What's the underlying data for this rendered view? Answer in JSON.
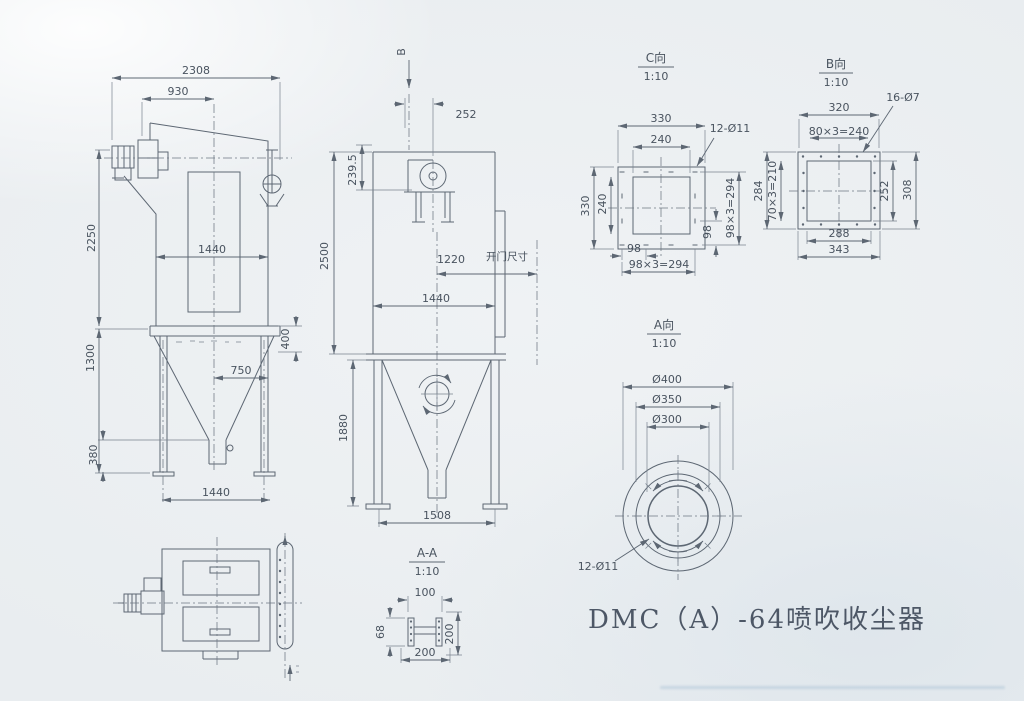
{
  "caption": "DMC（A）-64喷吹收尘器",
  "views": {
    "front": {
      "dims": {
        "overall_width": "2308",
        "drive_span": "930",
        "body_height": "2250",
        "body_width": "1440",
        "leg_height": "1300",
        "hopper_offset": "750",
        "discharge_height": "380",
        "inlet_drop": "400",
        "base_width": "1440"
      }
    },
    "side": {
      "section_label": "B",
      "door_note": "开门尺寸",
      "dims": {
        "inlet_width": "252",
        "inlet_drop": "239.5",
        "body_height": "2500",
        "door_offset": "1220",
        "body_width": "1440",
        "leg_height": "1880",
        "base_width": "1508"
      }
    },
    "view_c": {
      "title": "C向",
      "scale": "1:10",
      "holes": "12-Ø11",
      "dims": {
        "flange_width": "330",
        "opening_width": "240",
        "flange_height": "330",
        "opening_height": "240",
        "pitch_right": "98",
        "pitch_total_right": "98×3=294",
        "pitch_bottom": "98",
        "pitch_total_bottom": "98×3=294"
      }
    },
    "view_b": {
      "title": "B向",
      "scale": "1:10",
      "holes": "16-Ø7",
      "dims": {
        "bolt_span_width": "320",
        "pitch_width": "80×3=240",
        "flange_height_left": "284",
        "pitch_height": "70×3=210",
        "opening_height": "252",
        "flange_height": "308",
        "opening_width": "288",
        "flange_width": "343"
      }
    },
    "view_a": {
      "title": "A向",
      "scale": "1:10",
      "holes": "12-Ø11",
      "dims": {
        "outer_dia": "Ø400",
        "bolt_circle_dia": "Ø350",
        "inner_dia": "Ø300"
      }
    },
    "section_aa": {
      "title": "A-A",
      "scale": "1:10",
      "dims": {
        "flange_width": "100",
        "beam_height": "68",
        "side_span": "200",
        "base_span": "200"
      }
    }
  }
}
